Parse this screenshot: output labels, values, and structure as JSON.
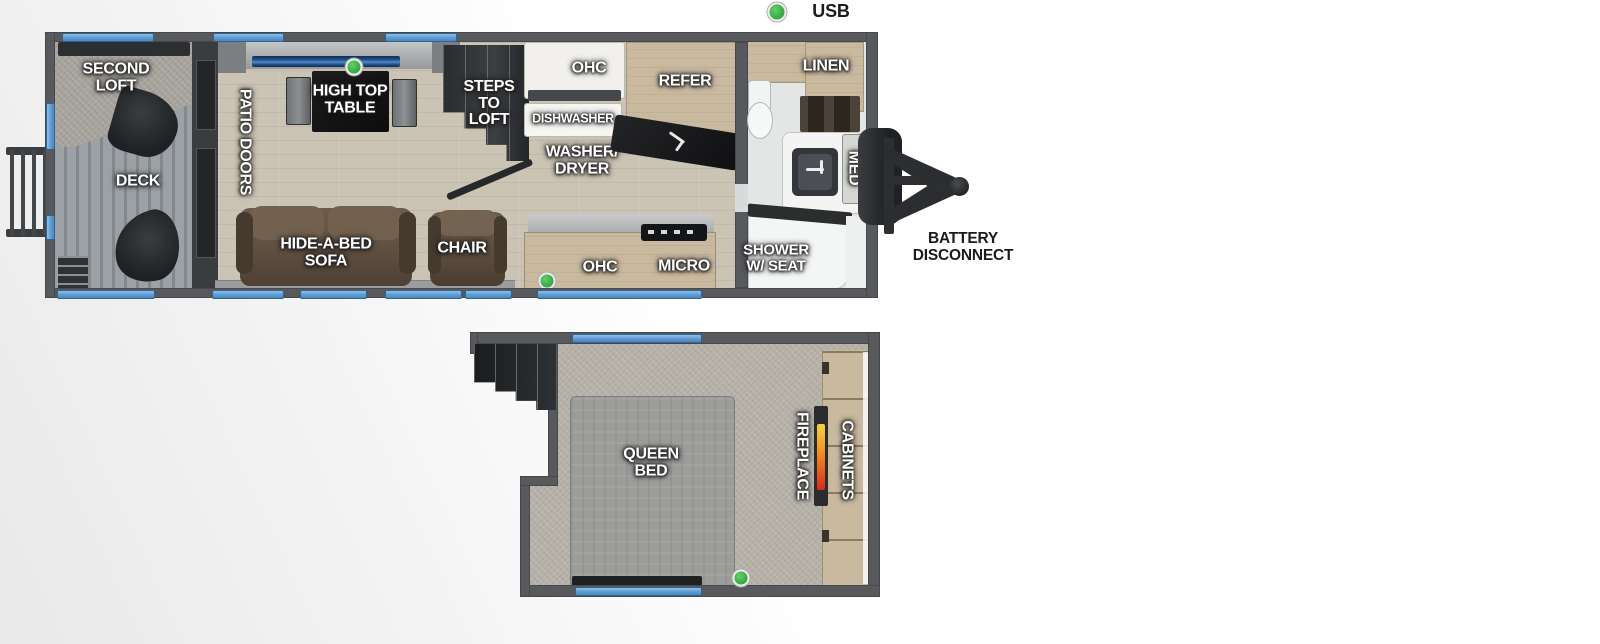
{
  "legend": {
    "usb": "USB"
  },
  "annotations": {
    "battery_disconnect": "BATTERY\nDISCONNECT"
  },
  "floor1": {
    "second_loft": "SECOND\nLOFT",
    "deck": "DECK",
    "patio_doors": "PATIO DOORS",
    "high_top_table": "HIGH TOP\nTABLE",
    "steps_to_loft": "STEPS\nTO\nLOFT",
    "ohc_top": "OHC",
    "dishwasher": "DISHWASHER",
    "washer_dryer": "WASHER/\nDRYER",
    "refer": "REFER",
    "hide_a_bed_sofa": "HIDE-A-BED\nSOFA",
    "chair": "CHAIR",
    "ohc_bottom": "OHC",
    "micro": "MICRO",
    "linen": "LINEN",
    "med": "MED",
    "shower": "SHOWER\nW/ SEAT"
  },
  "floor2": {
    "queen_bed": "QUEEN\nBED",
    "fireplace": "FIREPLACE",
    "cabinets": "CABINETS"
  },
  "colors": {
    "usb_green": "#3cae4a",
    "window_blue": "#5d9bd2",
    "wall_gray": "#57595c",
    "cabinet_tan": "#c9b99f",
    "sofa_brown": "#5f4f41"
  }
}
